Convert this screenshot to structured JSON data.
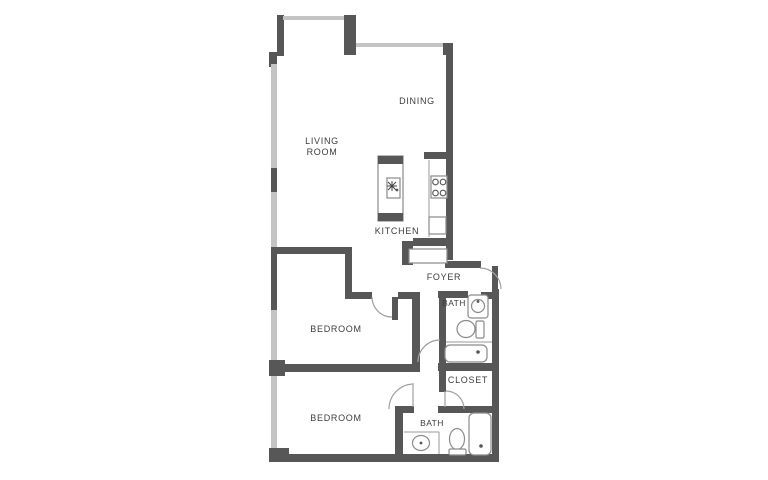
{
  "title": "Two bedroom apartment floor plan",
  "rooms": {
    "living_room_line1": "LIVING",
    "living_room_line2": "ROOM",
    "dining": "DINING",
    "kitchen": "KITCHEN",
    "foyer": "FOYER",
    "bath_upper": "BATH",
    "bedroom_upper": "BEDROOM",
    "bedroom_lower": "BEDROOM",
    "closet": "CLOSET",
    "bath_lower": "BATH"
  },
  "fixtures": [
    "kitchen-island-sink",
    "stove-burners",
    "kitchen-cabinet",
    "foyer-cabinet",
    "bath-upper-sink",
    "bath-upper-toilet",
    "bath-upper-tub",
    "bath-lower-sink",
    "bath-lower-toilet",
    "bath-lower-tub"
  ],
  "doors": [
    "entry-door",
    "bedroom-upper-door",
    "bedroom-lower-door",
    "closet-door",
    "bath-lower-door"
  ],
  "colors": {
    "wall_dark": "#575757",
    "wall_light": "#c4c4c4",
    "fixture_outline": "#8a8a8a",
    "door_arc": "#a0a0a0",
    "label_text": "#3d3d3d",
    "background": "#ffffff"
  }
}
